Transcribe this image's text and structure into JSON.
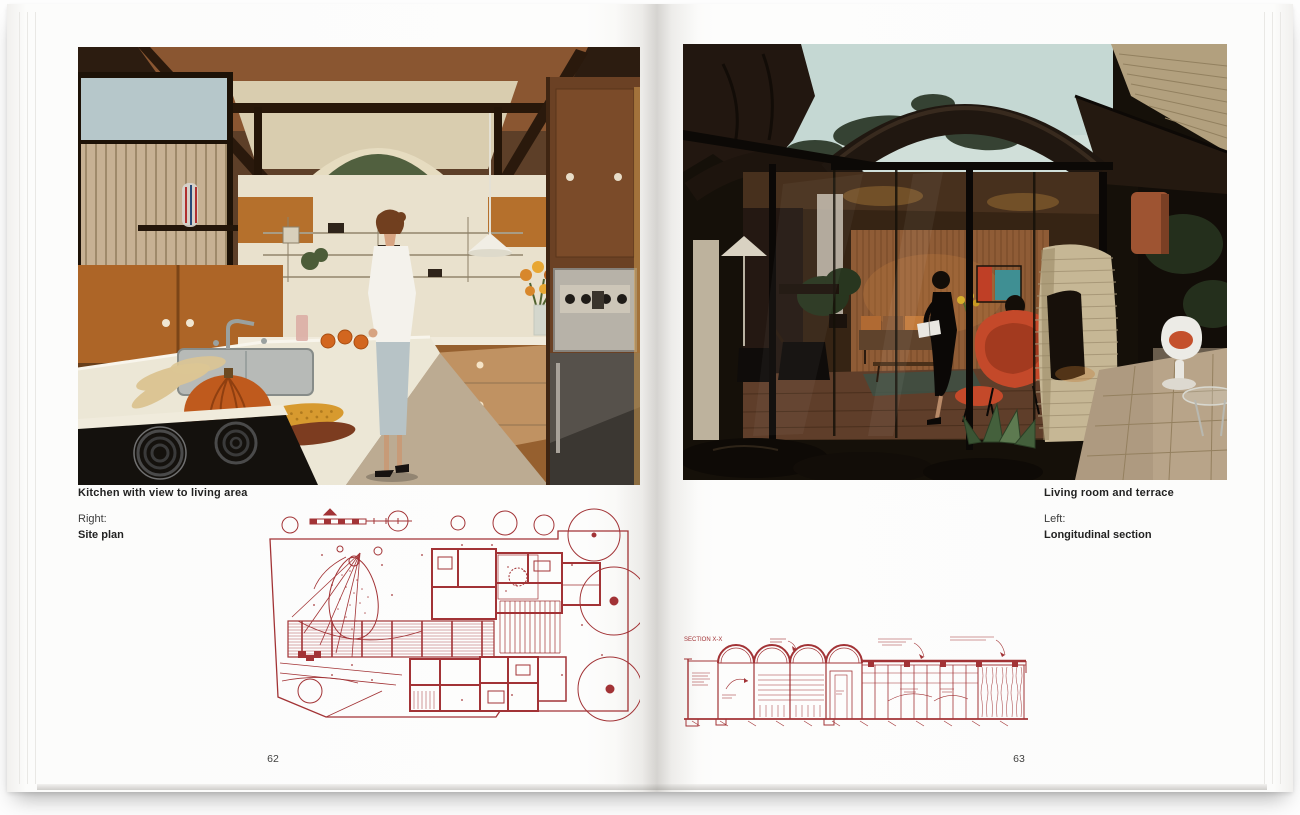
{
  "book": {
    "left_page": {
      "photo_caption": "Kitchen with view to living area",
      "reference_label": "Right:",
      "reference_caption": "Site plan",
      "page_number": "62"
    },
    "right_page": {
      "photo_caption": "Living room and terrace",
      "reference_label": "Left:",
      "reference_caption": "Longitudinal section",
      "page_number": "63",
      "drawing_annotation": "SECTION X-X"
    },
    "colors": {
      "drawing_red": "#a23336",
      "caption_text": "#222222"
    }
  }
}
